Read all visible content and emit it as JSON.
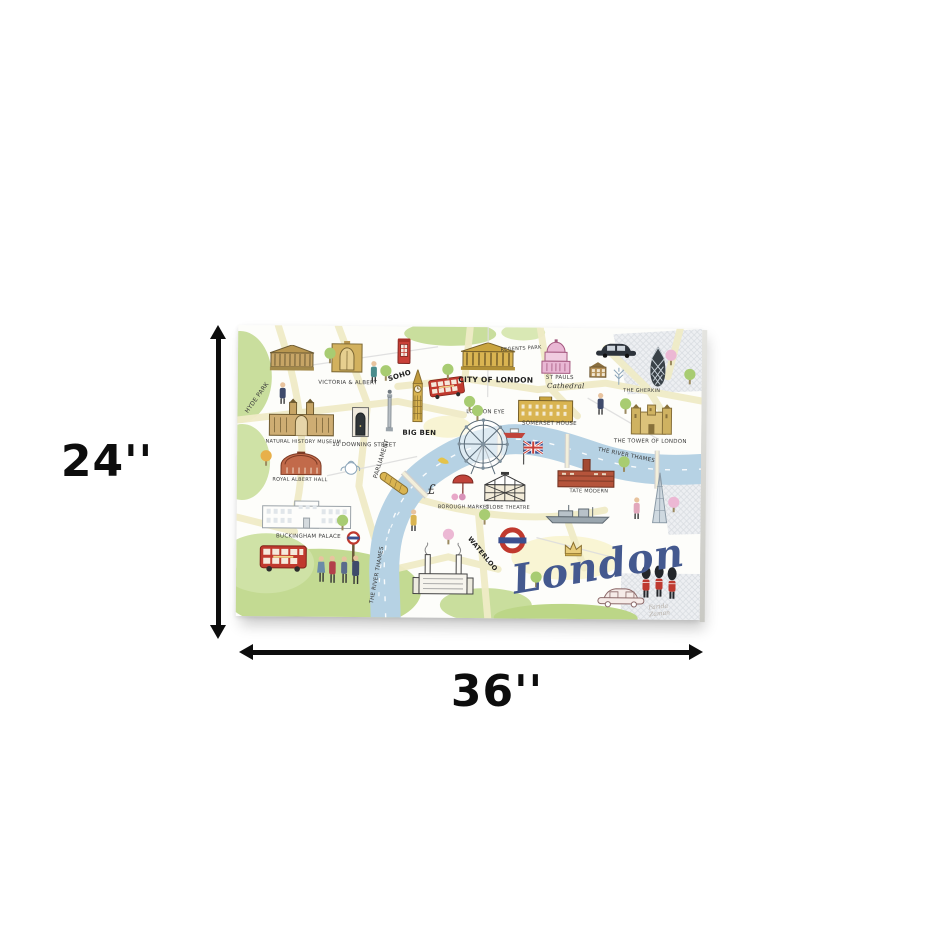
{
  "dimensions": {
    "height_label": "24''",
    "width_label": "36''"
  },
  "artwork": {
    "title": "London",
    "signature": "Farida Zaman"
  },
  "colors": {
    "arrow_black": "#0d0d0d",
    "canvas_bg": "#fdfdfa",
    "river_blue": "#b6d2e4",
    "park_green": "#c9de9d",
    "road_yellow": "#f0ebc7",
    "bus_red": "#c0392e",
    "script_blue": "#44598f",
    "landmark_gold": "#d9b451",
    "st_pauls_pink": "#e9b7d4"
  },
  "map": {
    "items": [
      {
        "n": "british-museum",
        "i": "museum",
        "x": 54,
        "y": 33
      },
      {
        "n": "victoria-albert-museum",
        "i": "vna",
        "x": 109,
        "y": 31
      },
      {
        "n": "victoria-albert-label",
        "t": "VICTORIA & ALBERT",
        "x": 110,
        "y": 58,
        "fs": 5.5
      },
      {
        "n": "tourist-with-bag",
        "i": "personTeal",
        "x": 136,
        "y": 46
      },
      {
        "n": "red-phone-box",
        "i": "phonebox",
        "x": 166,
        "y": 25
      },
      {
        "n": "soho-label",
        "t": "SOHO",
        "x": 162,
        "y": 50,
        "fs": 7,
        "rot": -18,
        "bold": 1
      },
      {
        "n": "big-ben",
        "i": "bigben",
        "x": 180,
        "y": 70
      },
      {
        "n": "big-ben-label",
        "t": "BIG BEN",
        "x": 182,
        "y": 107,
        "fs": 7,
        "bold": 1
      },
      {
        "n": "red-bus-city",
        "i": "bus",
        "x": 209,
        "y": 61,
        "sc": 0.75,
        "rot": -8
      },
      {
        "n": "city-of-london-building",
        "i": "citybldg",
        "x": 250,
        "y": 30
      },
      {
        "n": "regents-park-label",
        "t": "REGENTS PARK",
        "x": 283,
        "y": 22,
        "fs": 5,
        "rot": -4
      },
      {
        "n": "city-of-london-label",
        "t": "CITY OF LONDON",
        "x": 258,
        "y": 53,
        "fs": 7.5,
        "bold": 1
      },
      {
        "n": "st-pauls-cathedral",
        "i": "stpauls",
        "x": 318,
        "y": 29
      },
      {
        "n": "st-pauls-label",
        "t": "ST PAULS",
        "x": 322,
        "y": 51,
        "fs": 5.5
      },
      {
        "n": "st-pauls-script-label",
        "t": "Cathedral",
        "x": 328,
        "y": 59,
        "fs": 7,
        "script": 1
      },
      {
        "n": "black-taxi",
        "i": "taxiblack",
        "x": 378,
        "y": 21
      },
      {
        "n": "brown-townhouse",
        "i": "house",
        "x": 360,
        "y": 42
      },
      {
        "n": "winter-tree",
        "i": "wintertree",
        "x": 381,
        "y": 48
      },
      {
        "n": "man-in-navy-coat",
        "i": "personNavy",
        "x": 363,
        "y": 76
      },
      {
        "n": "gherkin",
        "i": "gherkin",
        "x": 420,
        "y": 38
      },
      {
        "n": "gherkin-label",
        "t": "THE GHERKIN",
        "x": 404,
        "y": 63,
        "fs": 5
      },
      {
        "n": "somerset-house",
        "i": "somerset",
        "x": 308,
        "y": 82
      },
      {
        "n": "somerset-house-label",
        "t": "SOMERSET HOUSE",
        "x": 312,
        "y": 97,
        "fs": 5.5
      },
      {
        "n": "tower-of-london",
        "i": "towercastle",
        "x": 414,
        "y": 91
      },
      {
        "n": "tower-of-london-label",
        "t": "THE TOWER OF LONDON",
        "x": 413,
        "y": 114,
        "fs": 5.5
      },
      {
        "n": "hyde-park-label",
        "t": "HYDE PARK",
        "x": 20,
        "y": 73,
        "fs": 6,
        "rot": -55
      },
      {
        "n": "walking-man",
        "i": "personNavy",
        "x": 45,
        "y": 68
      },
      {
        "n": "natural-history-museum",
        "i": "nhm",
        "x": 64,
        "y": 92
      },
      {
        "n": "natural-history-museum-label",
        "t": "NATURAL HISTORY MUSEUM",
        "x": 66,
        "y": 117,
        "fs": 5
      },
      {
        "n": "downing-street-door",
        "i": "door",
        "x": 123,
        "y": 96
      },
      {
        "n": "downing-street-label",
        "t": "10 DOWNING STREET",
        "x": 127,
        "y": 120,
        "fs": 5.5
      },
      {
        "n": "monument-column",
        "i": "column",
        "x": 152,
        "y": 85
      },
      {
        "n": "royal-albert-hall",
        "i": "rah",
        "x": 64,
        "y": 138
      },
      {
        "n": "royal-albert-hall-label",
        "t": "ROYAL ALBERT HALL",
        "x": 63,
        "y": 155,
        "fs": 5
      },
      {
        "n": "teapot",
        "i": "teapot",
        "x": 113,
        "y": 141
      },
      {
        "n": "orange-tree",
        "i": "treeOrange",
        "x": 29,
        "y": 133
      },
      {
        "n": "parliament-label",
        "t": "PARLIAMENT",
        "x": 145,
        "y": 133,
        "fs": 6,
        "rot": -73
      },
      {
        "n": "river-pier",
        "i": "goldbar",
        "x": 157,
        "y": 157,
        "rot": -55
      },
      {
        "n": "london-eye-label",
        "t": "LONDON EYE",
        "x": 248,
        "y": 86,
        "fs": 5.5
      },
      {
        "n": "london-eye",
        "i": "eye",
        "x": 246,
        "y": 120
      },
      {
        "n": "red-boat",
        "i": "boat",
        "x": 277,
        "y": 106
      },
      {
        "n": "union-jack-flag",
        "i": "ujflag",
        "x": 296,
        "y": 125
      },
      {
        "n": "yellow-bird",
        "i": "bird",
        "x": 206,
        "y": 133
      },
      {
        "n": "pound-sign",
        "t": "£",
        "x": 195,
        "y": 164,
        "fs": 13,
        "script": 1
      },
      {
        "n": "borough-market-umbrella",
        "i": "umbrella",
        "x": 226,
        "y": 159
      },
      {
        "n": "market-blossoms",
        "i": "blossom",
        "x": 222,
        "y": 170
      },
      {
        "n": "borough-market-label",
        "t": "BOROUGH MARKET",
        "x": 227,
        "y": 181,
        "fs": 5
      },
      {
        "n": "globe-theatre",
        "i": "globe",
        "x": 268,
        "y": 160
      },
      {
        "n": "globe-theatre-label",
        "t": "GLOBE THEATRE",
        "x": 271,
        "y": 181,
        "fs": 5
      },
      {
        "n": "tate-modern",
        "i": "tate",
        "x": 349,
        "y": 146
      },
      {
        "n": "tate-modern-label",
        "t": "TATE MODERN",
        "x": 352,
        "y": 164,
        "fs": 5
      },
      {
        "n": "river-thames-label-east",
        "t": "THE RIVER THAMES",
        "x": 389,
        "y": 128,
        "fs": 5.5,
        "rot": 11
      },
      {
        "n": "the-shard",
        "i": "shard",
        "x": 423,
        "y": 170
      },
      {
        "n": "hms-belfast-ship",
        "i": "ship",
        "x": 341,
        "y": 187
      },
      {
        "n": "woman-in-pink",
        "i": "personPink",
        "x": 400,
        "y": 180
      },
      {
        "n": "buckingham-palace",
        "i": "palace",
        "x": 70,
        "y": 189
      },
      {
        "n": "buckingham-palace-label",
        "t": "BUCKINGHAM PALACE",
        "x": 72,
        "y": 212,
        "fs": 5.5
      },
      {
        "n": "red-bus",
        "i": "bus",
        "x": 47,
        "y": 233
      },
      {
        "n": "underground-sign-pole",
        "i": "tubepole",
        "x": 117,
        "y": 221
      },
      {
        "n": "people-group",
        "i": "people",
        "x": 103,
        "y": 244
      },
      {
        "n": "lady-in-yellow",
        "i": "personYellow",
        "x": 177,
        "y": 194
      },
      {
        "n": "river-thames-label-south",
        "t": "THE RIVER THAMES",
        "x": 142,
        "y": 249,
        "fs": 5.5,
        "rot": -80
      },
      {
        "n": "battersea-power-station",
        "i": "battersea",
        "x": 207,
        "y": 242
      },
      {
        "n": "waterloo-label",
        "t": "WATERLOO",
        "x": 246,
        "y": 227,
        "fs": 6.5,
        "rot": 50,
        "bold": 1
      },
      {
        "n": "underground-roundel",
        "i": "roundel",
        "x": 276,
        "y": 213
      },
      {
        "n": "crown",
        "i": "crown",
        "x": 337,
        "y": 221
      },
      {
        "n": "pink-sketch-taxi",
        "i": "taxiout",
        "x": 385,
        "y": 268
      },
      {
        "n": "queens-guards",
        "i": "guards",
        "x": 423,
        "y": 254
      },
      {
        "n": "green-tree-1",
        "i": "tree",
        "x": 92,
        "y": 30
      },
      {
        "n": "green-tree-2",
        "i": "tree",
        "x": 148,
        "y": 47
      },
      {
        "n": "green-tree-3",
        "i": "tree",
        "x": 210,
        "y": 45
      },
      {
        "n": "green-tree-4",
        "i": "tree",
        "x": 240,
        "y": 86
      },
      {
        "n": "green-tree-5",
        "i": "tree",
        "x": 232,
        "y": 77
      },
      {
        "n": "green-tree-6",
        "i": "tree",
        "x": 388,
        "y": 78
      },
      {
        "n": "green-tree-7",
        "i": "tree",
        "x": 452,
        "y": 48
      },
      {
        "n": "green-tree-8",
        "i": "tree",
        "x": 248,
        "y": 190
      },
      {
        "n": "green-tree-9",
        "i": "tree",
        "x": 387,
        "y": 136
      },
      {
        "n": "green-tree-10",
        "i": "tree",
        "x": 106,
        "y": 197
      },
      {
        "n": "green-tree-11",
        "i": "tree",
        "x": 300,
        "y": 252
      },
      {
        "n": "pink-tree-1",
        "i": "treePink",
        "x": 433,
        "y": 29
      },
      {
        "n": "pink-tree-2",
        "i": "treePink",
        "x": 437,
        "y": 176
      },
      {
        "n": "pink-tree-3",
        "i": "treePink",
        "x": 212,
        "y": 210
      }
    ]
  }
}
